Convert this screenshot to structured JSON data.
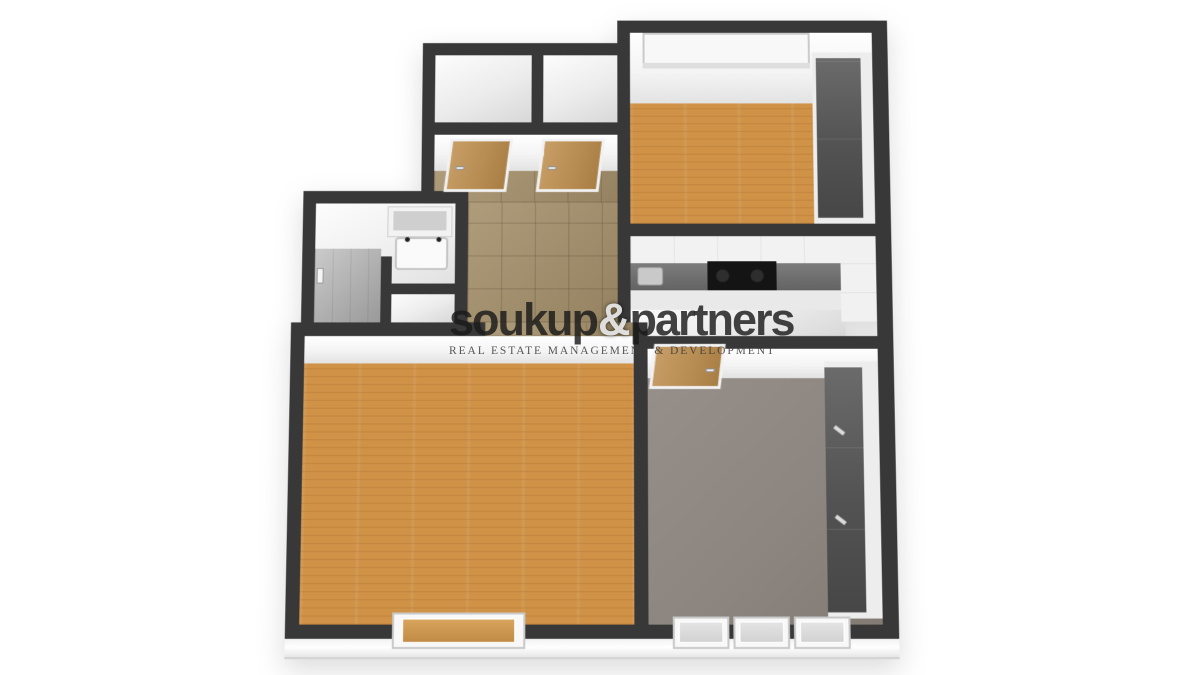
{
  "watermark": {
    "brand_left": "soukup",
    "brand_amp": "&",
    "brand_right": "partners",
    "tagline": "REAL ESTATE MANAGEMENT & DEVELOPMENT"
  },
  "palette": {
    "background": "#ffffff",
    "wall": "#383838",
    "wall_face": "#f4f4f4",
    "wood_floor": "#cf9247",
    "tile_floor": "#a5916c",
    "carpet_floor": "#8d8680",
    "shower_tile": "#adadad",
    "white_floor": "#ececec",
    "cabinet_white": "#f2f2f2",
    "countertop": "#6e6e6e",
    "cooktop": "#141414",
    "window_blind": "#e9d7ab",
    "door_wood": "#b78c52",
    "wardrobe_dark": "#535353"
  },
  "scene": {
    "type": "3d-top-view-floor-plan",
    "rooms": [
      {
        "name": "storage-closet-left",
        "floor": "white"
      },
      {
        "name": "storage-closet-right",
        "floor": "white"
      },
      {
        "name": "hallway",
        "floor": "beige-tile",
        "features": [
          "door-to-closet-left",
          "door-to-closet-right"
        ]
      },
      {
        "name": "bedroom-top-right",
        "floor": "wood",
        "features": [
          "triple-window-blinds",
          "wardrobe"
        ]
      },
      {
        "name": "bathroom",
        "floor": "white",
        "features": [
          "vanity-sink",
          "shower",
          "toilet-room"
        ]
      },
      {
        "name": "kitchen",
        "floor": "white",
        "features": [
          "upper-cabinets",
          "countertop",
          "sink",
          "cooktop",
          "corner-cabinets"
        ]
      },
      {
        "name": "living-room",
        "floor": "wood",
        "features": [
          "window"
        ]
      },
      {
        "name": "bedroom-bottom-right",
        "floor": "gray-carpet",
        "features": [
          "wardrobe",
          "entry-door",
          "triple-window"
        ]
      }
    ]
  }
}
